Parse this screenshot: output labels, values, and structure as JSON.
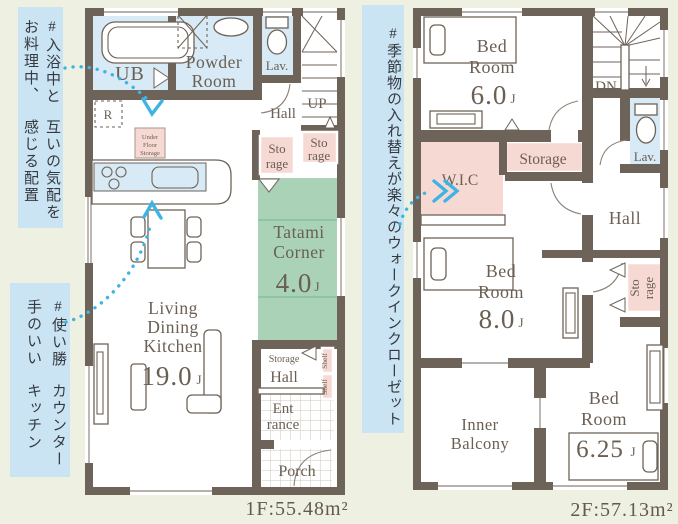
{
  "annotations": {
    "bath": {
      "line1": "#入浴中とお料理中、",
      "line2": "互いの気配を感じる配置"
    },
    "counter": {
      "line1": "#使い勝手のいい",
      "line2": "カウンターキッチン"
    },
    "wic": {
      "line1": "#季節物の入れ替えが楽々のウォークインクローゼット"
    }
  },
  "floor1": {
    "area_label": "1F:55.48m²",
    "ub": "UB",
    "powder_1": "Powder",
    "powder_2": "Room",
    "lav": "Lav.",
    "hall_upper": "Hall",
    "up": "UP",
    "storage_a_1": "Sto",
    "storage_a_2": "rage",
    "storage_b_1": "Sto",
    "storage_b_2": "rage",
    "fridge": "R",
    "ufs_1": "Under",
    "ufs_2": "Floor",
    "ufs_3": "Storage",
    "tatami_1": "Tatami",
    "tatami_2": "Corner",
    "tatami_size": "4.0",
    "tatami_unit": "J",
    "ldk_1": "Living",
    "ldk_2": "Dining",
    "ldk_3": "Kitchen",
    "ldk_size": "19.0",
    "ldk_unit": "J",
    "hall_storage": "Storage",
    "hall_lower": "Hall",
    "shelf_1": "Shelf",
    "shelf_2": "Shelf",
    "entrance_1": "Ent",
    "entrance_2": "rance",
    "porch": "Porch"
  },
  "floor2": {
    "area_label": "2F:57.13m²",
    "bed1_1": "Bed",
    "bed1_2": "Room",
    "bed1_size": "6.0",
    "bed1_unit": "J",
    "dn": "DN",
    "lav": "Lav.",
    "storage": "Storage",
    "wic": "W.I.C",
    "hall": "Hall",
    "bed2_1": "Bed",
    "bed2_2": "Room",
    "bed2_size": "8.0",
    "bed2_unit": "J",
    "storage_side_1": "Sto",
    "storage_side_2": "rage",
    "balcony_1": "Inner",
    "balcony_2": "Balcony",
    "bed3_1": "Bed",
    "bed3_2": "Room",
    "bed3_size": "6.25",
    "bed3_unit": "J"
  },
  "colors": {
    "wall": "#6e6358",
    "water_room": "#d7eaf5",
    "storage_pink": "#f7d9d3",
    "tatami_green": "#a9d2b6",
    "annotation_bg": "#cbe4f4",
    "arrow_blue": "#3fb4e3",
    "background": "#eef1e1"
  }
}
